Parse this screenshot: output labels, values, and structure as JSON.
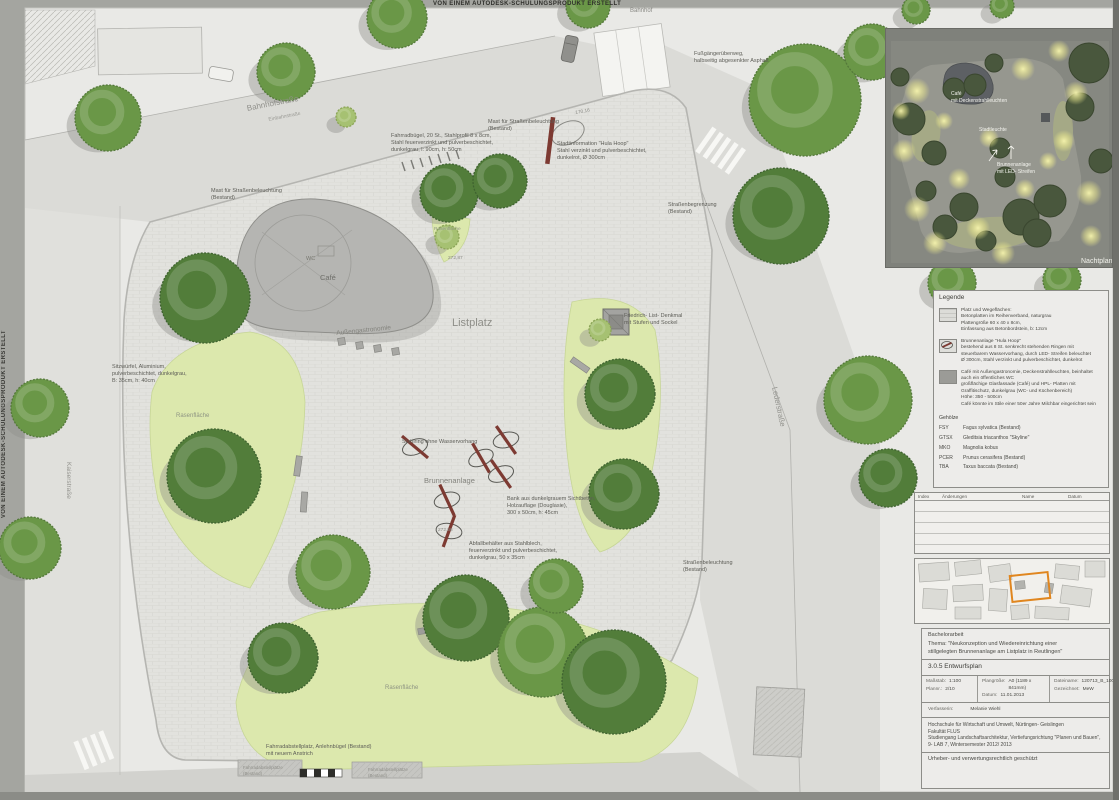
{
  "watermark": {
    "text": "VON EINEM AUTODESK-SCHULUNGSPRODUKT ERSTELLT"
  },
  "plan": {
    "annotations": [
      {
        "name": "street-label-bahnhofstrasse",
        "x": 246,
        "y": 104,
        "text": "Bahnhofstraße",
        "fs": 8,
        "rot": -11,
        "color": "#90908b"
      },
      {
        "name": "street-label-einbahnstrasse",
        "x": 268,
        "y": 117,
        "text": "Einbahnstraße",
        "fs": 5,
        "rot": -11,
        "color": "#9a9a95"
      },
      {
        "name": "plaza-label-listplatz",
        "x": 452,
        "y": 316,
        "text": "Listplatz",
        "fs": 11,
        "color": "#8e8e88"
      },
      {
        "name": "street-label-lederstrasse",
        "x": 779,
        "y": 386,
        "text": "Lederstraße",
        "fs": 7.5,
        "rot": 78,
        "color": "#90908b"
      },
      {
        "name": "street-label-kaiserstrasse",
        "x": 72,
        "y": 462,
        "text": "Kaiserstraße",
        "fs": 6.5,
        "rot": 90,
        "color": "#94948f"
      },
      {
        "name": "label-bahnhof",
        "x": 630,
        "y": 8,
        "text": "Bahnhof",
        "fs": 6,
        "color": "#8b8b86"
      },
      {
        "name": "label-cafe",
        "x": 320,
        "y": 273,
        "text": "Café",
        "fs": 7.5,
        "color": "#6f6f6a"
      },
      {
        "name": "label-wc",
        "x": 306,
        "y": 256,
        "text": "WC",
        "fs": 5.5,
        "color": "#77776f"
      },
      {
        "name": "label-aussengastronomie",
        "x": 336,
        "y": 330,
        "text": "Außengastronomie",
        "fs": 6.5,
        "rot": -6,
        "color": "#83837d"
      },
      {
        "name": "label-brunnenanlage",
        "x": 424,
        "y": 476,
        "text": "Brunnenanlage",
        "fs": 7.5,
        "color": "#83837d"
      },
      {
        "name": "label-rasenflaeche-west",
        "x": 176,
        "y": 413,
        "text": "Rasenfläche",
        "fs": 6,
        "color": "#8f9583"
      },
      {
        "name": "label-rasenflaeche-nord",
        "x": 434,
        "y": 227,
        "text": "Rasenfläche",
        "fs": 4.8,
        "color": "#8f9583"
      },
      {
        "name": "label-rasenflaeche-sued",
        "x": 385,
        "y": 685,
        "text": "Rasenfläche",
        "fs": 6,
        "color": "#8f9583"
      },
      {
        "name": "annotation-fahrradbuegel",
        "x": 391,
        "y": 133,
        "w": 112,
        "text": "Fahrradbügel, 20 St., Stahlprofil 8 x 8cm,\nStahl feuerverzinkt und pulverbeschichtet,\ndunkelgrau, l: 90cm, h: 50cm"
      },
      {
        "name": "annotation-mast-nord",
        "x": 488,
        "y": 119,
        "w": 85,
        "text": "Mast für Straßenbeleuchtung\n(Bestand)"
      },
      {
        "name": "annotation-mast-west",
        "x": 211,
        "y": 188,
        "w": 85,
        "text": "Mast für Straßenbeleuchtung\n(Bestand)"
      },
      {
        "name": "annotation-stadtinformation",
        "x": 557,
        "y": 141,
        "w": 92,
        "text": "Stadtinformation \"Hula Hoop\"\nStahl verzinkt und pulverbeschichtet,\ndunkelrot, Ø 300cm"
      },
      {
        "name": "annotation-fussgaengerueberweg",
        "x": 694,
        "y": 51,
        "w": 82,
        "text": "Fußgängerüberweg,\nhalbseitig abgesenkter Asphalt"
      },
      {
        "name": "annotation-strassenbegrenzung",
        "x": 668,
        "y": 202,
        "w": 60,
        "text": "Straßenbegrenzung\n(Bestand)"
      },
      {
        "name": "annotation-denkmal",
        "x": 624,
        "y": 313,
        "w": 74,
        "text": "Friedrich- List- Denkmal\nmit Stufen und Sockel"
      },
      {
        "name": "annotation-sitzwuerfel",
        "x": 112,
        "y": 364,
        "w": 86,
        "text": "Sitzwürfel, Aluminium,\npulverbeschichtet, dunkelgrau,\nB: 35cm, h: 40cm"
      },
      {
        "name": "annotation-stahlring",
        "x": 402,
        "y": 439,
        "w": 96,
        "text": "Stahlring ohne Wasservorhang"
      },
      {
        "name": "annotation-bank",
        "x": 507,
        "y": 496,
        "w": 90,
        "text": "Bank aus dunkelgrauem Sichtbeton,\nHolzauflage (Douglasie),\n300 x 50cm, h: 45cm"
      },
      {
        "name": "annotation-abfallbehaelter",
        "x": 469,
        "y": 541,
        "w": 100,
        "text": "Abfallbehälter aus Stahlblech,\nfeuerverzinkt und pulverbeschichtet,\ndunkelgrau, 50 x 35cm"
      },
      {
        "name": "annotation-fahrradabstellplatz",
        "x": 266,
        "y": 744,
        "w": 162,
        "text": "Fahrradabstellplatz, Anlehnbügel (Bestand)\nmit neuem Anstrich"
      },
      {
        "name": "annotation-strassenbeleuchtung",
        "x": 683,
        "y": 560,
        "w": 62,
        "text": "Straßenbeleuchtung\n(Bestand)"
      },
      {
        "name": "annotation-stellplaetze-west",
        "x": 243,
        "y": 765,
        "w": 58,
        "fs": 4.4,
        "cls": "faint",
        "text": "Fahrradabstellplätze\n(Bestand)"
      },
      {
        "name": "annotation-stellplaetze-ost",
        "x": 368,
        "y": 767,
        "w": 58,
        "fs": 4.4,
        "cls": "faint",
        "text": "Fahrradabstellplätze\n(Bestand)"
      },
      {
        "name": "elevation-272-87",
        "x": 448,
        "y": 256,
        "text": "272,87",
        "fs": 4.8,
        "color": "#888883"
      },
      {
        "name": "elevation-272-56",
        "x": 438,
        "y": 528,
        "text": "272,56",
        "fs": 4.8,
        "color": "#888883"
      },
      {
        "name": "dimension-170-16",
        "x": 575,
        "y": 111,
        "text": "170,16",
        "fs": 4.8,
        "rot": -10,
        "color": "#888883"
      }
    ]
  },
  "night_inset": {
    "annotations": [
      {
        "name": "night-label-cafe",
        "x": 950,
        "y": 90,
        "w": 62,
        "text": "Café\nmit Deckenstrahlleuchten"
      },
      {
        "name": "night-label-stadtleuchte",
        "x": 978,
        "y": 126,
        "w": 50,
        "text": "Stadtleuchte"
      },
      {
        "name": "night-label-brunnenanlage",
        "x": 996,
        "y": 161,
        "w": 58,
        "text": "Brunnenanlage\nmit LED- Streifen"
      },
      {
        "name": "night-inset-title",
        "x": 1080,
        "y": 256,
        "text": "Nachtplan",
        "fs": 7,
        "color": "#f0f0ea"
      }
    ]
  },
  "legend": {
    "title": "Legende",
    "entries": [
      {
        "icon": "paving",
        "text": "Platz und Wegeflächen:\nBetonplatten im Reihenverband, naturgrau\nPlattengröße 60 x 40 x 8cm,\nEinfassung aus Betonbordstein, b: 12cm"
      },
      {
        "icon": "fountain-ring",
        "text": "Brunnenanlage \"Hula Hoop\"\nbestehend aus 8 St. senkrecht stehenden Ringen mit\nsteuerbarem Wasservorhang, durch LED- Streifen beleuchtet\nØ 300cm, Stahl verzinkt und pulverbeschichtet, dunkelrot"
      },
      {
        "icon": "building",
        "text": "Café mit Außengastronomie, Deckenstrahlleuchten, beinhaltet auch ein öffentliches WC\ngroßflächige Glasfassade (Café) und HPL- Platten mit Graffitischutz, dunkelgrau (WC- und Küchenbereich)\nHöhe: 350 - 500cm\nCafé könnte im Stile einer 50er Jahre Milchbar eingerichtet sein"
      }
    ],
    "gehoelze_title": "Gehölze",
    "species": [
      {
        "code": "FSY",
        "name": "Fagus sylvatica (Bestand)"
      },
      {
        "code": "GTSX",
        "name": "Gleditsia triacanthos \"Skyline\""
      },
      {
        "code": "MKO",
        "name": "Magnolia kobus"
      },
      {
        "code": "PCER",
        "name": "Prunus cerasifera (Bestand)"
      },
      {
        "code": "TBA",
        "name": "Taxus baccata (Bestand)"
      }
    ]
  },
  "revision_table": {
    "headers": [
      "Index",
      "Änderungen",
      "Name",
      "Datum"
    ]
  },
  "title_block": {
    "project_type": "Bachelorarbeit",
    "thema": "Thema: \"Neukonzeption und Wiedereinrichtung einer\nstillgelegten Brunnenanlage am Listplatz in Reutlingen\"",
    "plan_name": "3.0.5 Entwurfsplan",
    "fields": [
      {
        "label": "Maßstab:",
        "value": "1:100"
      },
      {
        "label": "Plangröße:",
        "value": "A0 (1189 x 841mm)"
      },
      {
        "label": "Dateiname:",
        "value": "120713_B_100"
      },
      {
        "label": "Plannr.:",
        "value": "2/10"
      },
      {
        "label": "Datum:",
        "value": "11.01.2013"
      },
      {
        "label": "Gezeichnet:",
        "value": "MeW"
      }
    ],
    "author_label": "Verfasserin:",
    "author": "Melanie Wiehl",
    "institution": "Hochschule für Wirtschaft und Umwelt, Nürtingen- Geislingen\nFakultät FLUS\nStudiengang Landschaftsarchitektur, Vertiefungsrichtung \"Planen und Bauen\", 9- LAB 7, Wintersemester 2012/ 2013",
    "copyright": "Urheber- und verwertungsrechtlich geschützt"
  },
  "colors": {
    "paper": "#e9e9e6",
    "street": "#dbdbd7",
    "lawn": "#dce8ad",
    "fountain_red": "#7d3a32",
    "tree_tones": [
      "#6a9747",
      "#527d3a",
      "#a6c172"
    ],
    "tree_edges": [
      "#54793a",
      "#3f6330",
      "#8ba457"
    ],
    "night_glow": "#f5f3ac"
  },
  "drawing": {
    "trees": [
      [
        108,
        118,
        33,
        0
      ],
      [
        286,
        72,
        29,
        0
      ],
      [
        397,
        18,
        30,
        0
      ],
      [
        346,
        117,
        10,
        2
      ],
      [
        449,
        193,
        29,
        1
      ],
      [
        500,
        181,
        27,
        1
      ],
      [
        588,
        6,
        22,
        0
      ],
      [
        805,
        100,
        56,
        0
      ],
      [
        781,
        216,
        48,
        1
      ],
      [
        868,
        400,
        44,
        0
      ],
      [
        888,
        478,
        29,
        1
      ],
      [
        40,
        408,
        29,
        0
      ],
      [
        30,
        548,
        31,
        0
      ],
      [
        205,
        298,
        45,
        1
      ],
      [
        214,
        476,
        47,
        1
      ],
      [
        333,
        572,
        37,
        0
      ],
      [
        283,
        658,
        35,
        1
      ],
      [
        466,
        618,
        43,
        1
      ],
      [
        543,
        652,
        45,
        0
      ],
      [
        614,
        682,
        52,
        1
      ],
      [
        620,
        394,
        35,
        1
      ],
      [
        624,
        494,
        35,
        1
      ],
      [
        556,
        586,
        27,
        0
      ],
      [
        952,
        283,
        24,
        0
      ],
      [
        1062,
        280,
        19,
        0
      ],
      [
        872,
        52,
        28,
        0
      ],
      [
        916,
        10,
        14,
        0
      ],
      [
        1002,
        6,
        12,
        0
      ],
      [
        447,
        237,
        12,
        2
      ],
      [
        600,
        330,
        11,
        2
      ]
    ],
    "rings": [
      [
        415,
        447,
        -20,
        40
      ],
      [
        506,
        440,
        -15,
        55
      ],
      [
        481,
        458,
        -25,
        60
      ],
      [
        501,
        474,
        -20,
        55
      ],
      [
        447,
        500,
        -15,
        65
      ],
      [
        449,
        531,
        10,
        -70
      ]
    ],
    "night_trees": [
      [
        908,
        118,
        16
      ],
      [
        933,
        152,
        12
      ],
      [
        953,
        88,
        11
      ],
      [
        974,
        84,
        11
      ],
      [
        993,
        62,
        9
      ],
      [
        1088,
        62,
        20
      ],
      [
        1079,
        106,
        14
      ],
      [
        999,
        147,
        10
      ],
      [
        1004,
        176,
        10
      ],
      [
        963,
        206,
        14
      ],
      [
        944,
        226,
        12
      ],
      [
        1020,
        216,
        18
      ],
      [
        1049,
        200,
        16
      ],
      [
        1036,
        232,
        14
      ],
      [
        899,
        76,
        9
      ],
      [
        1100,
        160,
        12
      ],
      [
        925,
        190,
        10
      ],
      [
        985,
        240,
        10
      ]
    ],
    "night_glows": [
      [
        916,
        90,
        13
      ],
      [
        903,
        150,
        12
      ],
      [
        916,
        208,
        13
      ],
      [
        958,
        178,
        11
      ],
      [
        988,
        137,
        10
      ],
      [
        1022,
        68,
        12
      ],
      [
        1058,
        50,
        11
      ],
      [
        1075,
        92,
        12
      ],
      [
        1063,
        140,
        11
      ],
      [
        1088,
        192,
        13
      ],
      [
        1024,
        188,
        10
      ],
      [
        977,
        227,
        12
      ],
      [
        934,
        242,
        12
      ],
      [
        1002,
        252,
        12
      ],
      [
        1090,
        235,
        11
      ],
      [
        943,
        120,
        9
      ],
      [
        900,
        110,
        9
      ],
      [
        1047,
        160,
        9
      ]
    ]
  }
}
